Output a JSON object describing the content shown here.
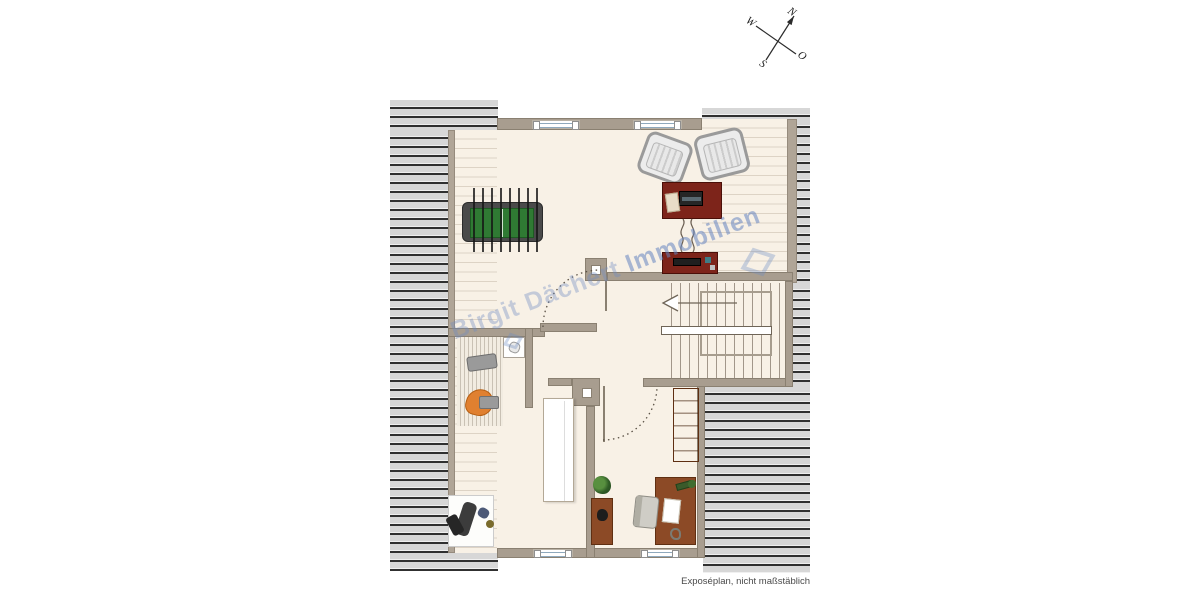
{
  "page": {
    "footer_note": "Exposéplan, nicht maßstäblich"
  },
  "watermark": {
    "lead": "Birgit Dächert ",
    "emphasis": "Immobilien"
  },
  "compass": {
    "north": "N",
    "east": "O",
    "south": "S",
    "west": "W"
  },
  "colors": {
    "floor": "#f8f1e6",
    "wall": "#a89d8f",
    "roof_stripe": "#303030",
    "roof_bg": "#d7d7d7",
    "furniture_red": "#7d241a",
    "furniture_brown": "#8c4a26",
    "foosball_green": "#2f7a33",
    "watermark_blue": "#6e8cc3"
  },
  "furniture": {
    "items": [
      "foosball-table",
      "armchair-left",
      "armchair-right",
      "console-table",
      "tv-lowboard",
      "staircase",
      "washbasin",
      "washing-machine",
      "bath-seat",
      "exercise-equipment",
      "wardrobe",
      "bookshelf",
      "plant",
      "side-cabinet",
      "desk",
      "office-chair"
    ]
  }
}
